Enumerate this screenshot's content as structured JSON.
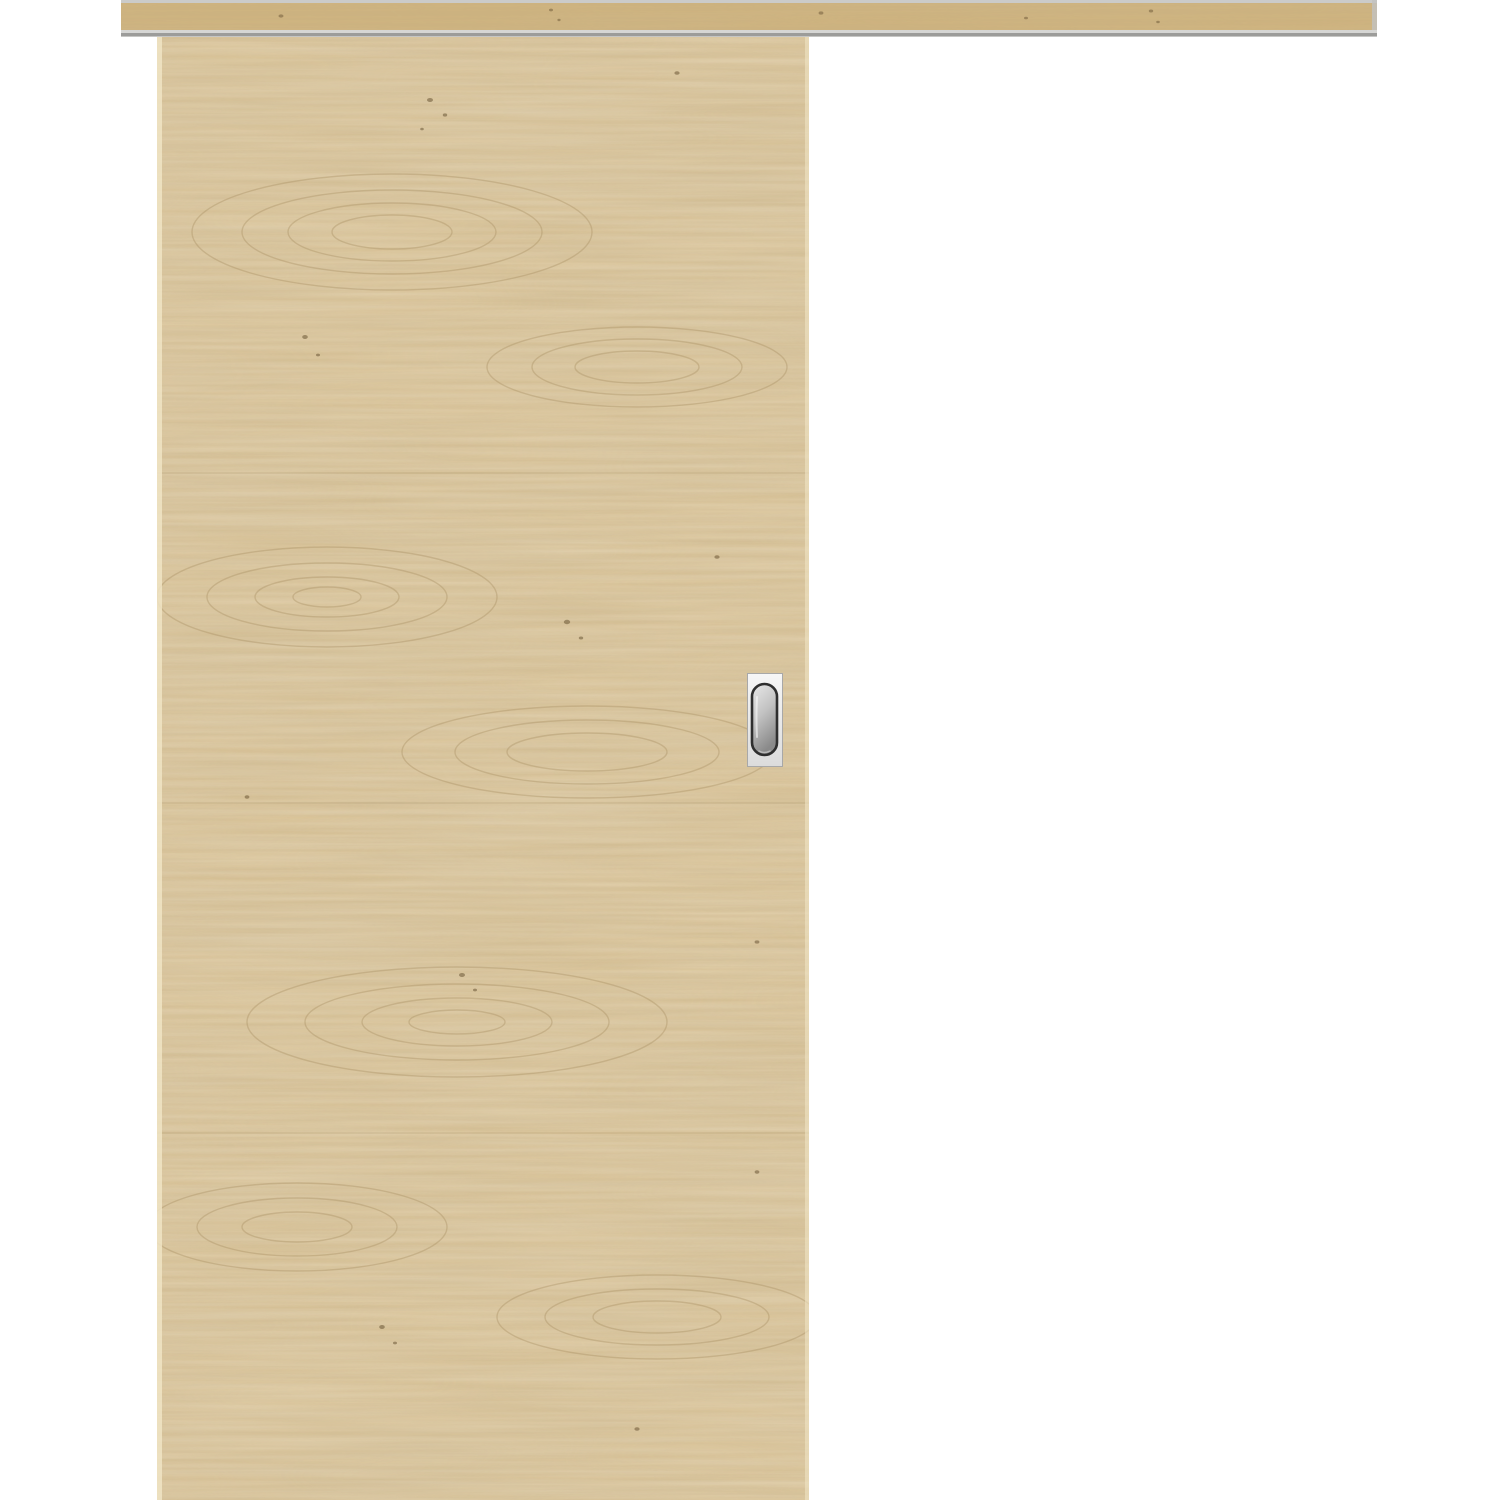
{
  "scene": {
    "label": "wooden sliding door product photo",
    "background_color": "#ffffff",
    "track": {
      "label": "sliding-door-track-pelmet",
      "wood_base": "#d0b47e",
      "grain_stroke": "#a3895c",
      "rail_gray_top": "#cbcbc9",
      "strip_light": "#d6d6d4",
      "strip_dark": "#9c9c9a",
      "strip_lower": "#c6c6c4",
      "end_cap": "#c2c2c0"
    },
    "door": {
      "label": "oak-veneer-door-leaf",
      "wood_base": "#dcc496",
      "grain_stroke": "#a3895c",
      "knot_color": "#6b5635",
      "seam_color": "#8f7748",
      "edge_light": "#f0e4c4"
    },
    "handle": {
      "label": "stainless-flush-pull-handle",
      "plate_light": "#f6f6f6",
      "plate_dark": "#dcdcdc",
      "plate_border": "#a8a8a8",
      "ring_color": "#2f2f2f",
      "recess_light": "#e9e9e9",
      "recess_mid": "#c2c2c2",
      "recess_dark": "#8a8a8a",
      "recess_highlight": "#ffffff"
    }
  }
}
